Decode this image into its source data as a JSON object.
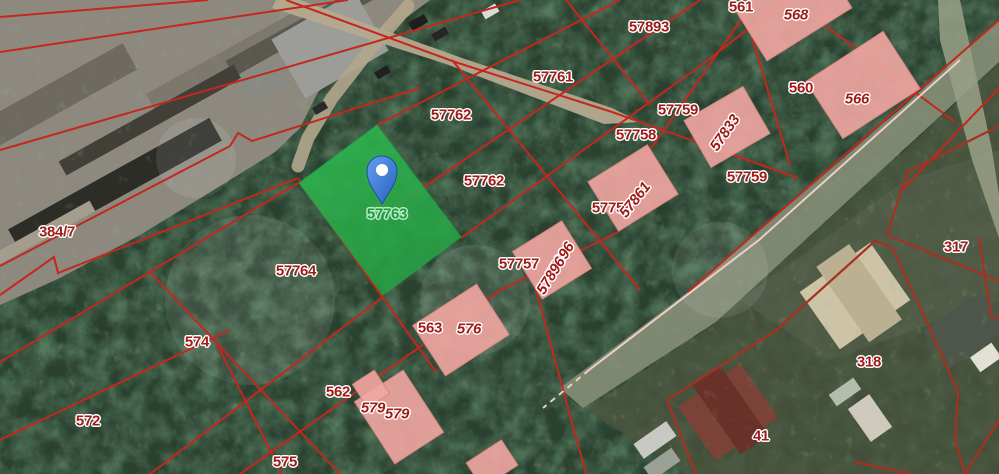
{
  "map": {
    "colors": {
      "boundary_main": "#c4271d",
      "boundary_dark": "#a83020",
      "road_edge_pale": "#eccfc7",
      "building_fill": "#f2a6a2",
      "building_stroke": "#d98781",
      "selected_fill": "#2db34e",
      "selected_fill2": "#27a545",
      "label_red": "#9e1b17",
      "label_green": "#1d9b44",
      "pin_blue": "#4a86dd",
      "pin_blue_dark": "#2a60bd"
    },
    "selected_parcel": {
      "id": "57763",
      "polygon": [
        [
          299,
          183
        ],
        [
          377,
          125
        ],
        [
          461,
          237
        ],
        [
          383,
          295
        ]
      ],
      "label": {
        "text": "57763",
        "x": 387,
        "y": 214
      }
    },
    "pin": {
      "x": 382,
      "y": 171
    },
    "region_labels": [
      {
        "text": "57893",
        "x": 649,
        "y": 27,
        "rot": 0,
        "style": "plot"
      },
      {
        "text": "561",
        "x": 741,
        "y": 7,
        "rot": 0,
        "style": "plot"
      },
      {
        "text": "568",
        "x": 796,
        "y": 15,
        "rot": 0,
        "style": "bldg"
      },
      {
        "text": "57761",
        "x": 553,
        "y": 77,
        "rot": 0,
        "style": "plot"
      },
      {
        "text": "560",
        "x": 801,
        "y": 88,
        "rot": 0,
        "style": "plot"
      },
      {
        "text": "566",
        "x": 857,
        "y": 99,
        "rot": 0,
        "style": "bldg"
      },
      {
        "text": "57762",
        "x": 451,
        "y": 115,
        "rot": 0,
        "style": "plot"
      },
      {
        "text": "57759",
        "x": 678,
        "y": 110,
        "rot": 0,
        "style": "plot"
      },
      {
        "text": "57758",
        "x": 636,
        "y": 135,
        "rot": 0,
        "style": "plot"
      },
      {
        "text": "57833",
        "x": 725,
        "y": 133,
        "rot": -55,
        "style": "bldg"
      },
      {
        "text": "384/7",
        "x": 57,
        "y": 232,
        "rot": 0,
        "style": "plot"
      },
      {
        "text": "57762",
        "x": 484,
        "y": 181,
        "rot": 0,
        "style": "plot"
      },
      {
        "text": "57759",
        "x": 747,
        "y": 177,
        "rot": 0,
        "style": "plot"
      },
      {
        "text": "57758",
        "x": 612,
        "y": 208,
        "rot": 0,
        "style": "plot"
      },
      {
        "text": "57861",
        "x": 635,
        "y": 200,
        "rot": -52,
        "style": "bldg"
      },
      {
        "text": "57764",
        "x": 296,
        "y": 271,
        "rot": 0,
        "style": "plot"
      },
      {
        "text": "57757",
        "x": 519,
        "y": 264,
        "rot": 0,
        "style": "plot"
      },
      {
        "text": "57896",
        "x": 560,
        "y": 261,
        "rot": -58,
        "style": "bldg"
      },
      {
        "text": "57896",
        "x": 551,
        "y": 276,
        "rot": -58,
        "style": "bldg"
      },
      {
        "text": "317",
        "x": 956,
        "y": 247,
        "rot": 0,
        "style": "plot"
      },
      {
        "text": "574",
        "x": 197,
        "y": 342,
        "rot": 0,
        "style": "plot"
      },
      {
        "text": "563",
        "x": 430,
        "y": 328,
        "rot": 0,
        "style": "plot"
      },
      {
        "text": "576",
        "x": 469,
        "y": 329,
        "rot": 0,
        "style": "bldg"
      },
      {
        "text": "562",
        "x": 338,
        "y": 392,
        "rot": 0,
        "style": "plot"
      },
      {
        "text": "579",
        "x": 373,
        "y": 408,
        "rot": 0,
        "style": "bldg"
      },
      {
        "text": "579",
        "x": 397,
        "y": 414,
        "rot": 0,
        "style": "bldg"
      },
      {
        "text": "572",
        "x": 88,
        "y": 421,
        "rot": 0,
        "style": "plot"
      },
      {
        "text": "575",
        "x": 285,
        "y": 462,
        "rot": 0,
        "style": "plot"
      },
      {
        "text": "318",
        "x": 869,
        "y": 362,
        "rot": 0,
        "style": "plot"
      },
      {
        "text": "41",
        "x": 761,
        "y": 436,
        "rot": 0,
        "style": "plot"
      }
    ],
    "buildings_pink": [
      {
        "cx": 793,
        "cy": 8,
        "w": 100,
        "h": 62,
        "rot": -32
      },
      {
        "cx": 863,
        "cy": 85,
        "w": 92,
        "h": 68,
        "rot": -33
      },
      {
        "cx": 727,
        "cy": 127,
        "w": 68,
        "h": 54,
        "rot": -30
      },
      {
        "cx": 633,
        "cy": 188,
        "w": 70,
        "h": 58,
        "rot": -32
      },
      {
        "cx": 552,
        "cy": 260,
        "w": 58,
        "h": 56,
        "rot": -32
      },
      {
        "cx": 461,
        "cy": 330,
        "w": 76,
        "h": 60,
        "rot": -33
      },
      {
        "cx": 399,
        "cy": 417,
        "w": 58,
        "h": 74,
        "rot": -33
      },
      {
        "cx": 371,
        "cy": 389,
        "w": 26,
        "h": 28,
        "rot": -33
      },
      {
        "cx": 492,
        "cy": 464,
        "w": 42,
        "h": 30,
        "rot": -33
      }
    ],
    "boundary_lines": {
      "main": [
        [
          [
            0,
            17
          ],
          [
            208,
            0
          ]
        ],
        [
          [
            0,
            52
          ],
          [
            348,
            0
          ]
        ],
        [
          [
            0,
            150
          ],
          [
            520,
            0
          ]
        ],
        [
          [
            0,
            266
          ],
          [
            230,
            146
          ],
          [
            238,
            133
          ],
          [
            252,
            141
          ],
          [
            420,
            88
          ]
        ],
        [
          [
            286,
            0
          ],
          [
            455,
            62
          ],
          [
            612,
            112
          ],
          [
            798,
            178
          ]
        ],
        [
          [
            0,
            295
          ],
          [
            54,
            257
          ],
          [
            58,
            273
          ],
          [
            298,
            178
          ]
        ],
        [
          [
            0,
            362
          ],
          [
            298,
            183
          ]
        ],
        [
          [
            377,
            125
          ],
          [
            620,
            0
          ]
        ],
        [
          [
            390,
            210
          ],
          [
            700,
            0
          ]
        ],
        [
          [
            150,
            474
          ],
          [
            383,
            297
          ]
        ],
        [
          [
            461,
            238
          ],
          [
            700,
            66
          ],
          [
            786,
            0
          ]
        ],
        [
          [
            240,
            474
          ],
          [
            499,
            291
          ],
          [
            618,
            232
          ]
        ],
        [
          [
            0,
            440
          ],
          [
            230,
            330
          ]
        ],
        [
          [
            215,
            340
          ],
          [
            282,
            474
          ]
        ],
        [
          [
            150,
            272
          ],
          [
            340,
            474
          ]
        ],
        [
          [
            452,
            60
          ],
          [
            640,
            290
          ]
        ],
        [
          [
            566,
            0
          ],
          [
            650,
            105
          ]
        ],
        [
          [
            643,
            160
          ],
          [
            755,
            0
          ]
        ],
        [
          [
            741,
            0
          ],
          [
            790,
            165
          ]
        ],
        [
          [
            800,
            7
          ],
          [
            955,
            122
          ]
        ],
        [
          [
            900,
            192
          ],
          [
            999,
            88
          ]
        ],
        [
          [
            688,
            292
          ],
          [
            999,
            20
          ]
        ],
        [
          [
            298,
            178
          ],
          [
            383,
            298
          ],
          [
            436,
            372
          ]
        ],
        [
          [
            531,
            272
          ],
          [
            586,
            474
          ]
        ]
      ],
      "dark": [
        [
          [
            775,
            331
          ],
          [
            875,
            241
          ]
        ],
        [
          [
            775,
            331
          ],
          [
            667,
            400
          ]
        ],
        [
          [
            667,
            400
          ],
          [
            696,
            474
          ]
        ],
        [
          [
            875,
            241
          ],
          [
            892,
            247
          ]
        ],
        [
          [
            892,
            247
          ],
          [
            935,
            340
          ],
          [
            958,
            392
          ],
          [
            955,
            440
          ]
        ],
        [
          [
            955,
            440
          ],
          [
            965,
            474
          ]
        ],
        [
          [
            999,
            420
          ],
          [
            965,
            474
          ]
        ],
        [
          [
            855,
            462
          ],
          [
            910,
            474
          ]
        ],
        [
          [
            887,
            235
          ],
          [
            999,
            281
          ]
        ],
        [
          [
            887,
            235
          ],
          [
            907,
            172
          ],
          [
            999,
            126
          ]
        ],
        [
          [
            979,
            237
          ],
          [
            991,
            316
          ],
          [
            999,
            318
          ]
        ]
      ],
      "pale": [
        [
          [
            960,
            60
          ],
          [
            759,
            240
          ],
          [
            589,
            370
          ]
        ]
      ],
      "pale_dashed": [
        [
          [
            589,
            370
          ],
          [
            543,
            408
          ]
        ]
      ]
    }
  }
}
